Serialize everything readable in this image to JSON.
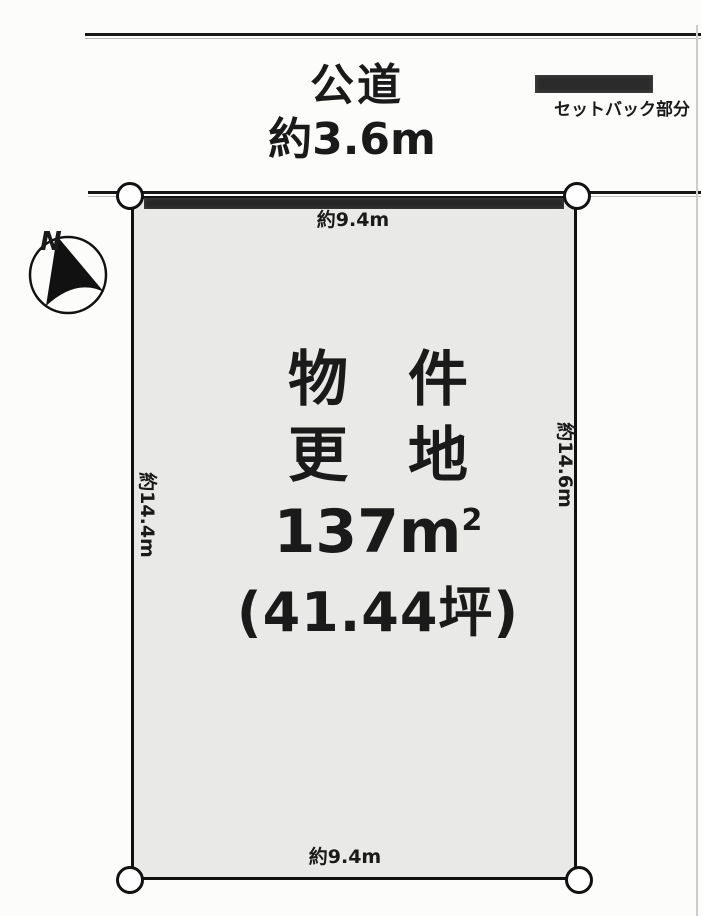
{
  "road": {
    "name": "公道",
    "width_label": "約3.6m"
  },
  "legend": {
    "setback_label": "セットバック部分"
  },
  "compass": {
    "north_label": "N"
  },
  "plot": {
    "property_line1": "物　件",
    "property_line2": "更　地",
    "area_main": "137m",
    "area_exponent": "2",
    "area_tsubo": "(41.44坪)",
    "dim_top": "約9.4m",
    "dim_bottom": "約9.4m",
    "dim_left": "約14.4m",
    "dim_right": "約14.6m"
  },
  "colors": {
    "ink": "#1a1a1a",
    "plot_fill": "#e9e9e7",
    "setback_fill": "#2b2b2b",
    "paper": "#fcfcfb"
  }
}
